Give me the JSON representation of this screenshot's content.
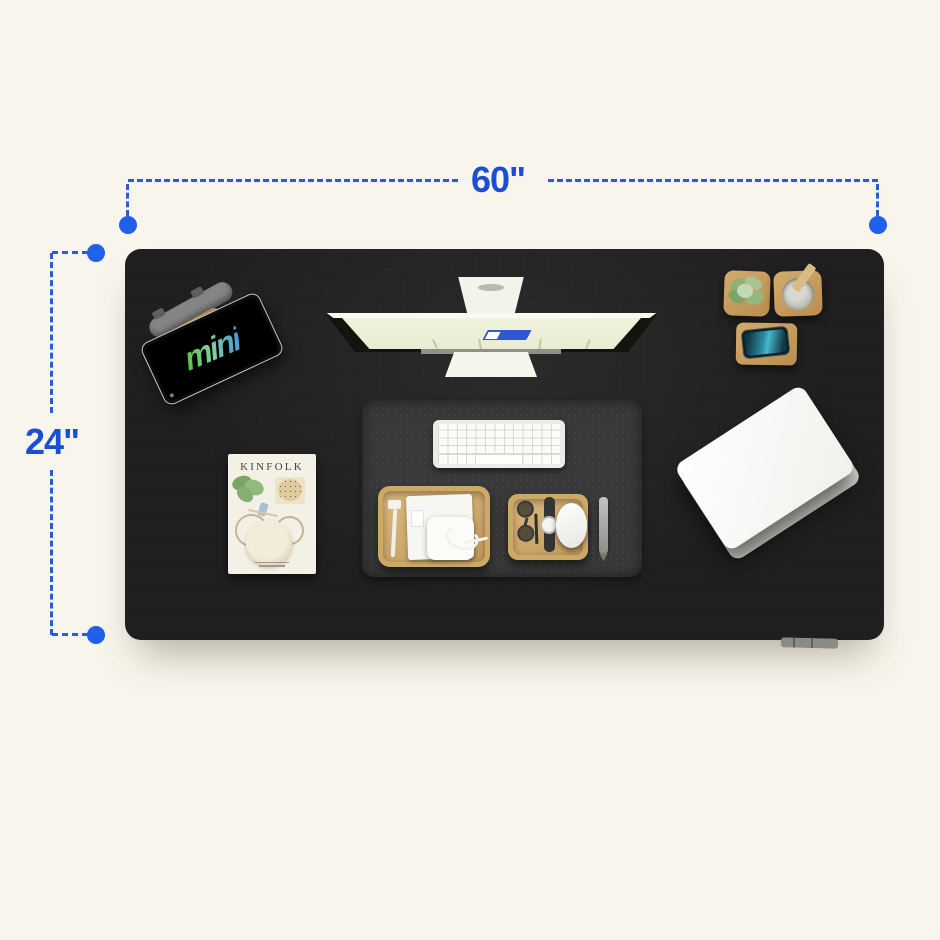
{
  "scene": {
    "background_color": "#f8f6ec",
    "description_labels_visible": [
      "60\"",
      "24\""
    ]
  },
  "annotations": {
    "width_label": "60\"",
    "height_label": "24\"",
    "line_color": "#2b5bdc",
    "dot_color": "#2160e8",
    "label_color": "#1b4ed2"
  },
  "desk": {
    "surface_color": "#1f1f1f"
  },
  "items": {
    "headphones": {
      "color": "#858585",
      "pad_color": "#bb9154"
    },
    "tablet": {
      "screen_text": "mini",
      "body_color": "#0d0d0d",
      "text_gradient": [
        "#5cc24f",
        "#7ed0a0",
        "#4f9fd8"
      ]
    },
    "monitor": {
      "stand_color": "#f3f3ea",
      "screen_color": "#eef0da",
      "window_color": "#2b59d6"
    },
    "plant": {
      "pot_color": "#c9a263",
      "leaf_color": "#8db177"
    },
    "pen_holder": {
      "base_color": "#c9a263",
      "cup_color": "#b0b0a8",
      "stick_color": "#dcba84"
    },
    "wireless_charger": {
      "pad_color": "#c49a5d",
      "phone_screen_colors": [
        "#0e3642",
        "#45b9c8"
      ]
    },
    "desk_mat": {
      "color": "#393939"
    },
    "keyboard": {
      "body_color": "#ebebe8",
      "key_color": "#fbfbfa"
    },
    "tray_left": {
      "wood_color": "#cda968",
      "contents": [
        "usb-cable",
        "notepad",
        "power-adapter",
        "charging-cable"
      ]
    },
    "tray_right": {
      "wood_color": "#cda968",
      "contents": [
        "eyeglasses",
        "watch",
        "mouse"
      ]
    },
    "mouse": {
      "color": "#f4f4f1"
    },
    "pen": {
      "color": "#a8a8a5"
    },
    "magazine": {
      "title": "KINFOLK",
      "cover_color": "#f3f0e6"
    },
    "laptop": {
      "color": "#f7f7f4"
    },
    "cable_organizer": {
      "color": "#8b8b86"
    }
  }
}
